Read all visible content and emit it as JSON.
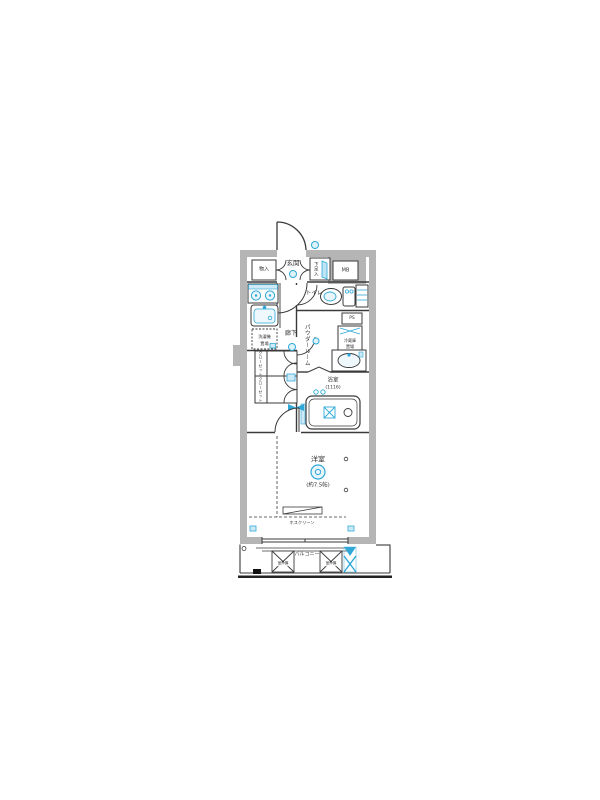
{
  "colors": {
    "background": "#ffffff",
    "wall_gray": "#b5b5b5",
    "line_black": "#3a3a3a",
    "fixture_blue": "#2fa8d8",
    "fixture_blue_light": "#d8eef9",
    "text": "#333333"
  },
  "floorplan": {
    "labels": {
      "genkan": "玄関",
      "storage": "物入",
      "shoe_box": "下足入",
      "meter_box": "MB",
      "toilet": "トイレ",
      "hallway": "廊下",
      "powder_room": "パウダールーム",
      "pipe_space": "PS",
      "fridge_line1": "冷蔵庫",
      "fridge_line2": "置場",
      "laundry_line1": "洗濯機",
      "laundry_line2": "置場",
      "closet_upper": "クローゼット",
      "closet_lower": "クローゼット",
      "bathroom": "浴室",
      "bathroom_size": "(1116)",
      "western_room": "洋室",
      "western_room_size": "(約7.5帖)",
      "hose_clean": "ホスクリーン",
      "balcony": "バルコニー",
      "ac_unit_left": "室外機",
      "ac_unit_right": "室外機"
    }
  }
}
